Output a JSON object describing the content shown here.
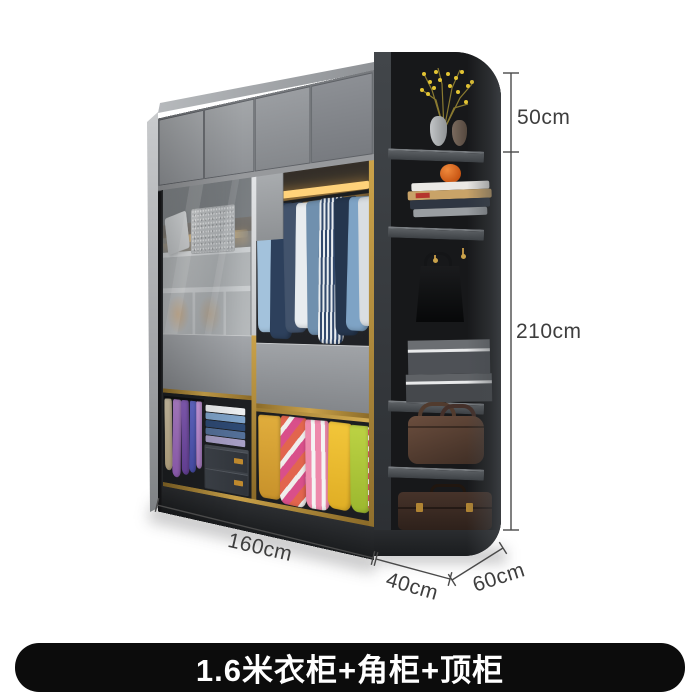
{
  "banner": {
    "label": "1.6米衣柜+角柜+顶柜"
  },
  "dimensions": {
    "top_cabinet_height": "50cm",
    "total_height": "210cm",
    "wardrobe_width": "160cm",
    "corner_width": "40cm",
    "corner_depth": "60cm"
  },
  "colors": {
    "gold_trim": "#b5913f",
    "banner_bg": "#0c0c0c",
    "banner_text": "#ffffff",
    "dimension_line": "#4a4a4a",
    "dimension_text": "#3e3e3e",
    "cabinet_gray": "#8d9094",
    "corner_cabinet_dark": "#232527",
    "led_glow": "#f5b34a"
  }
}
